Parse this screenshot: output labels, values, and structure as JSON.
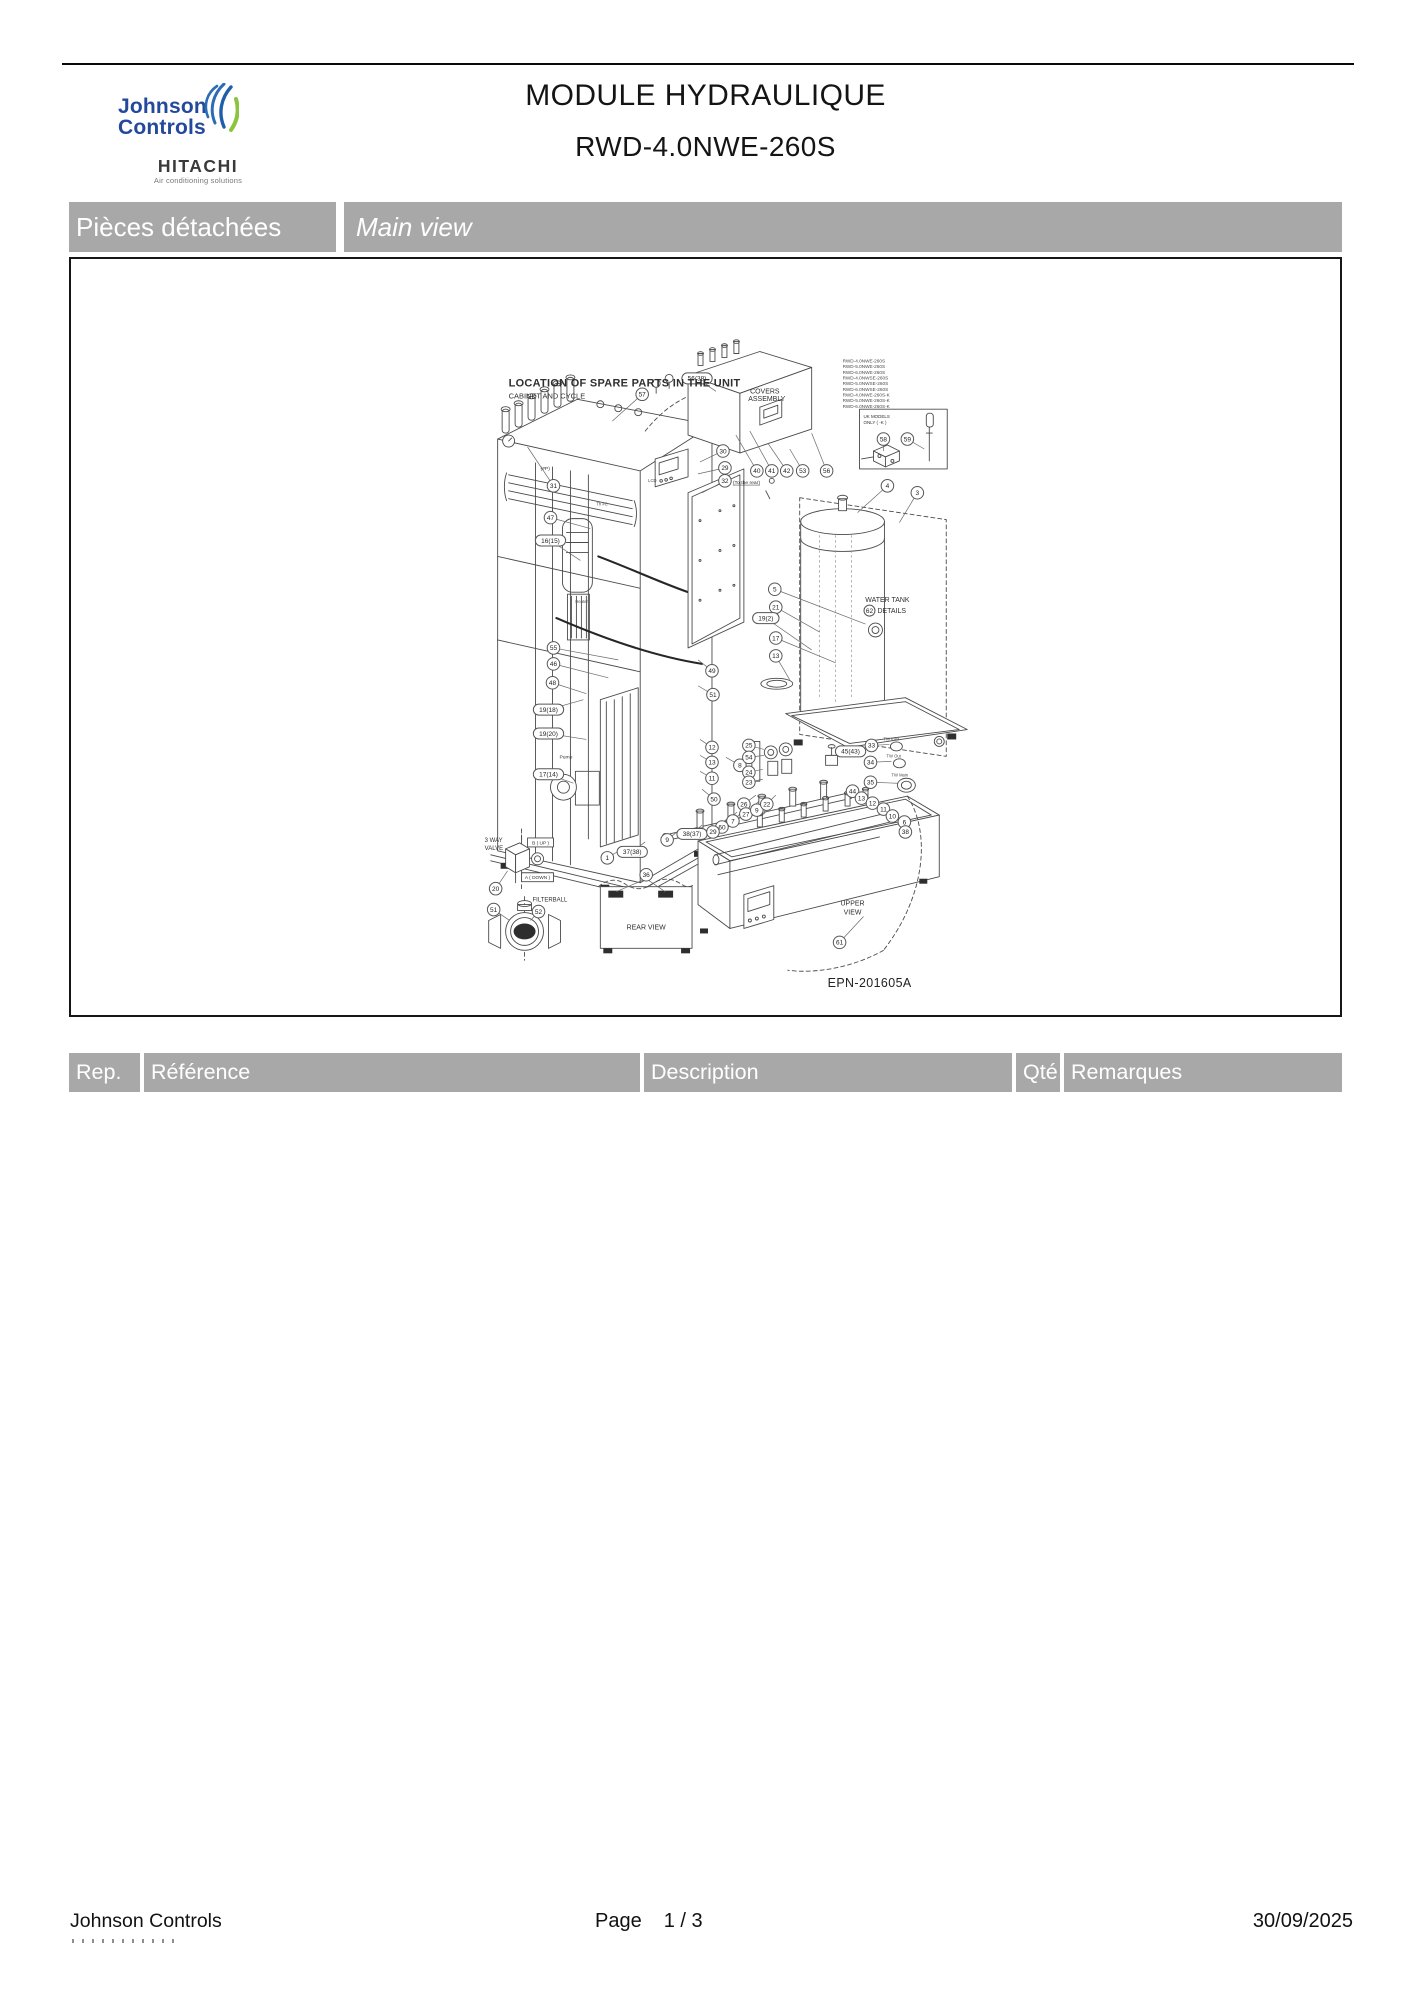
{
  "header": {
    "brand_line1": "Johnson",
    "brand_line2": "Controls",
    "brand_sub": "HITACHI",
    "brand_tagline": "Air conditioning solutions",
    "title": "MODULE HYDRAULIQUE",
    "subtitle": "RWD-4.0NWE-260S"
  },
  "section_bar": {
    "left": "Pièces détachées",
    "right": "Main view"
  },
  "diagram": {
    "labels": {
      "title": "LOCATION OF SPARE PARTS IN THE UNIT",
      "subtitle": "CABINET AND CYCLE",
      "covers_1": "COVERS",
      "covers_2": "ASSEMBLY",
      "uk_1": "UK MODELS",
      "uk_2": "ONLY ( -K )",
      "tank_1": "WATER TANK",
      "tank_2": "DETAILS",
      "tank_badge": "62",
      "upper_1": "UPPER",
      "upper_2": "VIEW",
      "rear": "REAR VIEW",
      "way3_1": "3 WAY",
      "way3_2": "VALVE",
      "b_up": "B ( UP )",
      "a_down": "A ( DOWN )",
      "filterball": "FILTERBALL",
      "pump": "Pump",
      "to_rear": "(To the rear)",
      "lcd": "LCD",
      "heater": "Heater",
      "th_c": "Th #C",
      "hash_p": "(#P)",
      "tw_inlet": "TW Inlet",
      "tw_out": "TW Out",
      "tw_main": "TW Main",
      "epn": "EPN-201605A"
    },
    "model_list": [
      "RWD-4.0NWE-260S",
      "RWD-5.0NWE-260S",
      "RWD-6.0NWE-260S",
      "RWD-4.0NWSE-260S",
      "RWD-5.0NWSE-260S",
      "RWD-6.0NWSE-260S",
      "RWD-4.0NWE-260S-K",
      "RWD-5.0NWE-260S-K",
      "RWD-6.0NWE-260S-K"
    ],
    "callouts": [
      {
        "n": "57",
        "x": 642,
        "y": 393,
        "lx": 612,
        "ly": 420
      },
      {
        "n": "31",
        "x": 553,
        "y": 485,
        "lx": 527,
        "ly": 446
      },
      {
        "n": "47",
        "x": 550,
        "y": 517,
        "lx": 590,
        "ly": 528
      },
      {
        "n": "16(15)",
        "x": 550,
        "y": 540,
        "lx": 580,
        "ly": 560
      },
      {
        "n": "55",
        "x": 553,
        "y": 648,
        "lx": 618,
        "ly": 660
      },
      {
        "n": "46",
        "x": 553,
        "y": 664,
        "lx": 608,
        "ly": 678
      },
      {
        "n": "48",
        "x": 552,
        "y": 683,
        "lx": 586,
        "ly": 694
      },
      {
        "n": "19(18)",
        "x": 548,
        "y": 710,
        "lx": 583,
        "ly": 700
      },
      {
        "n": "19(20)",
        "x": 548,
        "y": 734,
        "lx": 586,
        "ly": 740
      },
      {
        "n": "17(14)",
        "x": 548,
        "y": 775,
        "lx": 573,
        "ly": 784
      },
      {
        "n": "56(38)",
        "x": 697,
        "y": 377,
        "lx": 716,
        "ly": 390
      },
      {
        "n": "30",
        "x": 723,
        "y": 450,
        "lx": 700,
        "ly": 461
      },
      {
        "n": "29",
        "x": 725,
        "y": 467,
        "lx": 698,
        "ly": 473
      },
      {
        "n": "32",
        "x": 725,
        "y": 480,
        "lx": 702,
        "ly": 492
      },
      {
        "n": "40",
        "x": 757,
        "y": 470,
        "lx": 736,
        "ly": 434
      },
      {
        "n": "41",
        "x": 772,
        "y": 470,
        "lx": 750,
        "ly": 430
      },
      {
        "n": "42",
        "x": 787,
        "y": 470,
        "lx": 768,
        "ly": 442
      },
      {
        "n": "53",
        "x": 803,
        "y": 470,
        "lx": 790,
        "ly": 448
      },
      {
        "n": "56",
        "x": 827,
        "y": 470,
        "lx": 812,
        "ly": 432
      },
      {
        "n": "58",
        "x": 884,
        "y": 438,
        "lx": 884,
        "ly": 450
      },
      {
        "n": "59",
        "x": 908,
        "y": 438,
        "lx": 925,
        "ly": 448
      },
      {
        "n": "4",
        "x": 888,
        "y": 485,
        "lx": 858,
        "ly": 512
      },
      {
        "n": "3",
        "x": 918,
        "y": 492,
        "lx": 900,
        "ly": 522
      },
      {
        "n": "5",
        "x": 775,
        "y": 589,
        "lx": 866,
        "ly": 624
      },
      {
        "n": "21",
        "x": 776,
        "y": 607,
        "lx": 820,
        "ly": 632
      },
      {
        "n": "19(2)",
        "x": 766,
        "y": 618,
        "lx": 812,
        "ly": 650
      },
      {
        "n": "17",
        "x": 776,
        "y": 638,
        "lx": 836,
        "ly": 663
      },
      {
        "n": "13",
        "x": 776,
        "y": 656,
        "lx": 790,
        "ly": 680
      },
      {
        "n": "49",
        "x": 712,
        "y": 671,
        "lx": 698,
        "ly": 660
      },
      {
        "n": "51",
        "x": 713,
        "y": 695,
        "lx": 698,
        "ly": 686
      },
      {
        "n": "12",
        "x": 712,
        "y": 748,
        "lx": 700,
        "ly": 740
      },
      {
        "n": "13",
        "x": 712,
        "y": 763,
        "lx": 700,
        "ly": 756
      },
      {
        "n": "11",
        "x": 712,
        "y": 779,
        "lx": 700,
        "ly": 772
      },
      {
        "n": "8",
        "x": 740,
        "y": 766,
        "lx": 726,
        "ly": 758
      },
      {
        "n": "50",
        "x": 714,
        "y": 800,
        "lx": 702,
        "ly": 790
      },
      {
        "n": "1",
        "x": 607,
        "y": 859,
        "lx": 622,
        "ly": 850
      },
      {
        "n": "37(38)",
        "x": 632,
        "y": 853,
        "lx": 645,
        "ly": 843
      },
      {
        "n": "9",
        "x": 667,
        "y": 841,
        "lx": 678,
        "ly": 832
      },
      {
        "n": "38(37)",
        "x": 692,
        "y": 835,
        "lx": 702,
        "ly": 826
      },
      {
        "n": "20",
        "x": 495,
        "y": 890,
        "lx": 507,
        "ly": 872
      },
      {
        "n": "51",
        "x": 493,
        "y": 911,
        "lx": 509,
        "ly": 922
      },
      {
        "n": "52",
        "x": 538,
        "y": 913,
        "lx": 530,
        "ly": 922
      },
      {
        "n": "36",
        "x": 646,
        "y": 876
      },
      {
        "n": "61",
        "x": 840,
        "y": 944,
        "lx": 864,
        "ly": 918
      },
      {
        "n": "25",
        "x": 749,
        "y": 746,
        "lx": 764,
        "ly": 750
      },
      {
        "n": "54",
        "x": 749,
        "y": 758,
        "lx": 764,
        "ly": 756
      },
      {
        "n": "24",
        "x": 749,
        "y": 773,
        "lx": 763,
        "ly": 770
      },
      {
        "n": "23",
        "x": 749,
        "y": 783,
        "lx": 763,
        "ly": 780
      },
      {
        "n": "26",
        "x": 744,
        "y": 805,
        "lx": 756,
        "ly": 796
      },
      {
        "n": "27",
        "x": 746,
        "y": 815,
        "lx": 759,
        "ly": 802
      },
      {
        "n": "9",
        "x": 757,
        "y": 811,
        "lx": 768,
        "ly": 799
      },
      {
        "n": "22",
        "x": 767,
        "y": 805,
        "lx": 776,
        "ly": 796
      },
      {
        "n": "7",
        "x": 733,
        "y": 822,
        "lx": 747,
        "ly": 808
      },
      {
        "n": "60",
        "x": 722,
        "y": 828,
        "lx": 737,
        "ly": 813
      },
      {
        "n": "29",
        "x": 713,
        "y": 833,
        "lx": 729,
        "ly": 818
      },
      {
        "n": "45(43)",
        "x": 851,
        "y": 752,
        "lx": 838,
        "ly": 757
      },
      {
        "n": "33",
        "x": 872,
        "y": 746,
        "lx": 890,
        "ly": 745
      },
      {
        "n": "34",
        "x": 871,
        "y": 763,
        "lx": 892,
        "ly": 762
      },
      {
        "n": "35",
        "x": 871,
        "y": 783,
        "lx": 898,
        "ly": 784
      },
      {
        "n": "44",
        "x": 853,
        "y": 792,
        "lx": 861,
        "ly": 800
      },
      {
        "n": "13",
        "x": 862,
        "y": 799,
        "lx": 869,
        "ly": 806
      },
      {
        "n": "12",
        "x": 873,
        "y": 804,
        "lx": 879,
        "ly": 810
      },
      {
        "n": "11",
        "x": 884,
        "y": 810,
        "lx": 889,
        "ly": 815
      },
      {
        "n": "10",
        "x": 893,
        "y": 817,
        "lx": 897,
        "ly": 821
      },
      {
        "n": "6",
        "x": 905,
        "y": 823,
        "lx": 907,
        "ly": 827
      },
      {
        "n": "38",
        "x": 906,
        "y": 833,
        "lx": 901,
        "ly": 838
      }
    ]
  },
  "table": {
    "columns": [
      "Rep.",
      "Référence",
      "Description",
      "Qté",
      "Remarques"
    ]
  },
  "footer": {
    "company": "Johnson Controls",
    "page_label": "Page",
    "page_number": "1  /  3",
    "date": "30/09/2025"
  },
  "colors": {
    "bar_gray": "#a8a8a8",
    "brand_blue": "#24499c",
    "brand_green": "#8bc43f",
    "line": "#4a4a4a"
  }
}
